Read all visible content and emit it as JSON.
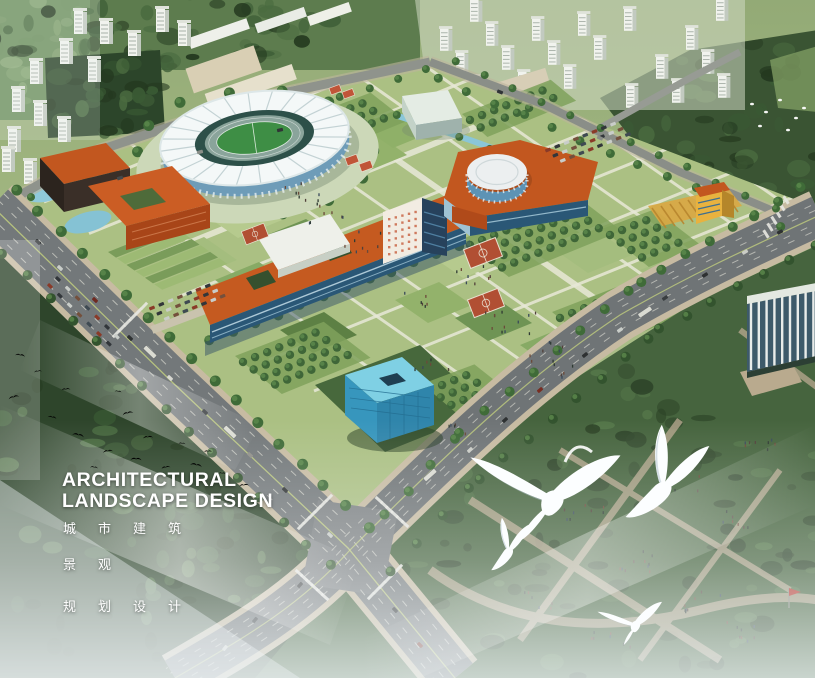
{
  "overlay": {
    "title_line1": "ARCHITECTURAL",
    "title_line2": "LANDSCAPE DESIGN",
    "subtitle_line1": "城市建筑",
    "subtitle_line2": "景观",
    "subtitle_line3": "规划设计"
  },
  "palette": {
    "building_orange": "#c2571f",
    "glass_blue": "#3796bd",
    "campus_lawn_green": "#abc083",
    "forest_green": "#2e452b",
    "road_gray": "#73787a",
    "mist_white": "#f4f8fa",
    "stadium_white": "#f4f8f8",
    "water_blue": "#8ac6d8",
    "title_text": "#ffffff"
  }
}
